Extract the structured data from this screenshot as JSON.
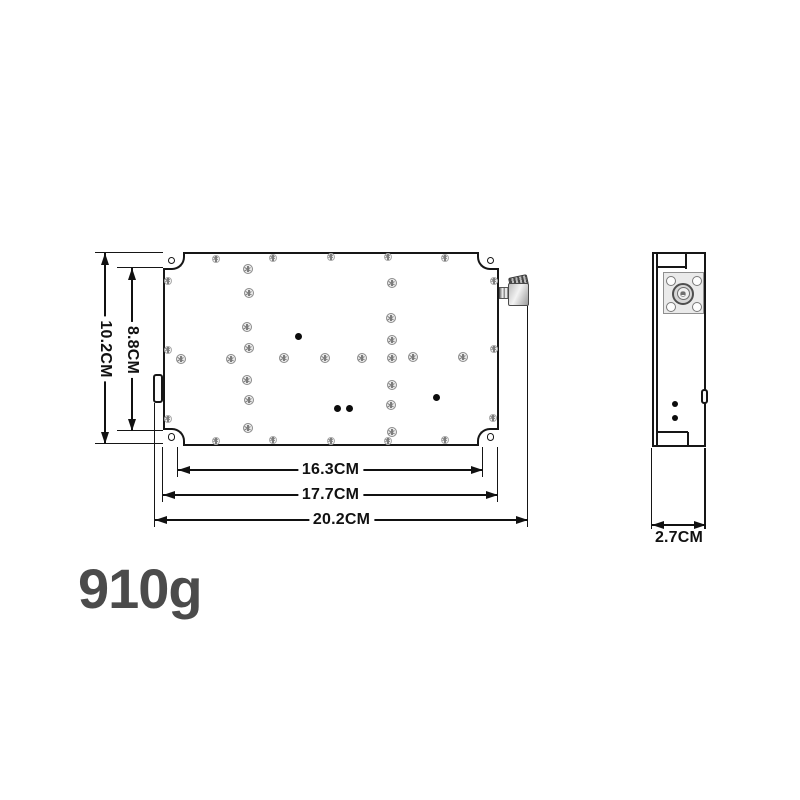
{
  "weight_label": "910g",
  "palette": {
    "line": "#161616",
    "text": "#111111",
    "weight_text": "#4b4b4b"
  },
  "front_view": {
    "body": {
      "x": 163,
      "y": 252,
      "w": 336,
      "h": 194
    },
    "corner_lugs": [
      {
        "corner": "tl",
        "x": 163,
        "y": 252,
        "w": 22,
        "h": 18,
        "hole": [
          171.5,
          260.5
        ]
      },
      {
        "corner": "tr",
        "x": 477,
        "y": 252,
        "w": 22,
        "h": 18,
        "hole": [
          490.5,
          260.5
        ]
      },
      {
        "corner": "bl",
        "x": 163,
        "y": 428,
        "w": 22,
        "h": 18,
        "hole": [
          171.5,
          437
        ]
      },
      {
        "corner": "br",
        "x": 477,
        "y": 428,
        "w": 22,
        "h": 18,
        "hole": [
          490.5,
          437
        ]
      }
    ],
    "hole_d": 7.5,
    "tab": {
      "x": 153,
      "y": 374,
      "w": 10,
      "h": 29
    },
    "connector": [
      {
        "cls": "kind-thread",
        "x": 499,
        "y": 287,
        "w": 12,
        "h": 12
      },
      {
        "cls": "kind-knurl",
        "x": 509,
        "y": 276,
        "w": 19,
        "h": 11
      },
      {
        "cls": "kind-nut",
        "x": 508,
        "y": 283,
        "w": 21,
        "h": 23
      }
    ],
    "screws_star": [
      [
        216,
        259
      ],
      [
        273,
        258
      ],
      [
        331,
        257
      ],
      [
        388,
        257
      ],
      [
        445,
        258
      ],
      [
        216,
        441
      ],
      [
        273,
        440
      ],
      [
        331,
        441
      ],
      [
        388,
        441
      ],
      [
        445,
        440
      ],
      [
        168,
        281
      ],
      [
        168,
        350
      ],
      [
        168,
        419
      ],
      [
        494,
        281
      ],
      [
        494,
        349
      ],
      [
        493,
        418
      ]
    ],
    "screws_cross": [
      [
        248,
        269
      ],
      [
        249,
        293
      ],
      [
        247,
        327
      ],
      [
        249,
        348
      ],
      [
        247,
        380
      ],
      [
        249,
        400
      ],
      [
        248,
        428
      ],
      [
        392,
        283
      ],
      [
        391,
        318
      ],
      [
        392,
        340
      ],
      [
        392,
        385
      ],
      [
        391,
        405
      ],
      [
        392,
        432
      ],
      [
        181,
        359
      ],
      [
        231,
        359
      ],
      [
        284,
        358
      ],
      [
        325,
        358
      ],
      [
        362,
        358
      ],
      [
        392,
        358
      ],
      [
        413,
        357
      ],
      [
        463,
        357
      ]
    ],
    "dot_d": 7,
    "dots": [
      [
        298,
        336
      ],
      [
        337,
        408
      ],
      [
        349,
        408
      ],
      [
        436,
        397
      ]
    ]
  },
  "side_view": {
    "body": {
      "x": 652,
      "y": 252,
      "w": 54,
      "h": 195
    },
    "inner_lines": [
      {
        "x": 657,
        "y": 252,
        "len": 195,
        "dir": "v"
      },
      {
        "x": 657,
        "y": 267,
        "len": 29,
        "dir": "h"
      },
      {
        "x": 686,
        "y": 252,
        "len": 17,
        "dir": "v"
      },
      {
        "x": 657,
        "y": 432,
        "len": 31,
        "dir": "h"
      },
      {
        "x": 688,
        "y": 432,
        "len": 15,
        "dir": "v"
      }
    ],
    "flange": {
      "x": 663,
      "y": 272,
      "w": 41,
      "h": 42
    },
    "flange_holes": [
      [
        670.5,
        280.5
      ],
      [
        696.5,
        280.5
      ],
      [
        670.5,
        306.5
      ],
      [
        696.5,
        306.5
      ]
    ],
    "flange_hole_d": 10,
    "rings": [
      {
        "cx": 683,
        "cy": 293.5,
        "d": 22,
        "cls": "ring-outer"
      },
      {
        "cx": 683,
        "cy": 293.5,
        "d": 13,
        "cls": "ring-inner"
      },
      {
        "cx": 683,
        "cy": 293.5,
        "d": 6,
        "cls": "ring-core"
      }
    ],
    "center_square": {
      "cx": 683,
      "cy": 293.5,
      "s": 3.5
    },
    "notch": {
      "x": 701,
      "y": 389,
      "w": 7,
      "h": 15
    },
    "dot_d": 6.5,
    "dots": [
      [
        675,
        404
      ],
      [
        675,
        418
      ]
    ]
  },
  "dimensions": [
    {
      "label": "10.2CM",
      "orient": "v",
      "x": 105,
      "from": 253,
      "to": 444,
      "ext": [
        {
          "x": 95,
          "y": 252.5,
          "len": 68,
          "dir": "h"
        },
        {
          "x": 95,
          "y": 443.5,
          "len": 68,
          "dir": "h"
        }
      ]
    },
    {
      "label": "8.8CM",
      "orient": "v",
      "x": 132,
      "from": 268,
      "to": 431,
      "ext": [
        {
          "x": 117,
          "y": 267.5,
          "len": 46,
          "dir": "h"
        },
        {
          "x": 117,
          "y": 430.5,
          "len": 46,
          "dir": "h"
        }
      ]
    },
    {
      "label": "16.3CM",
      "orient": "h",
      "y": 470,
      "from": 178,
      "to": 483,
      "ext": [
        {
          "x": 177.5,
          "y": 447,
          "len": 30,
          "dir": "v"
        },
        {
          "x": 482.5,
          "y": 447,
          "len": 30,
          "dir": "v"
        }
      ]
    },
    {
      "label": "17.7CM",
      "orient": "h",
      "y": 495,
      "from": 163,
      "to": 498,
      "ext": [
        {
          "x": 162.5,
          "y": 447,
          "len": 55,
          "dir": "v"
        },
        {
          "x": 497.5,
          "y": 447,
          "len": 55,
          "dir": "v"
        }
      ]
    },
    {
      "label": "20.2CM",
      "orient": "h",
      "y": 520,
      "from": 155,
      "to": 528,
      "ext": [
        {
          "x": 154.5,
          "y": 403,
          "len": 124,
          "dir": "v"
        },
        {
          "x": 527.5,
          "y": 306,
          "len": 221,
          "dir": "v"
        }
      ]
    },
    {
      "label": "2.7CM",
      "orient": "h",
      "y": 525,
      "from": 652,
      "to": 706,
      "label_below": true,
      "ext": [
        {
          "x": 651.5,
          "y": 448,
          "len": 84,
          "dir": "v"
        },
        {
          "x": 705,
          "y": 448,
          "len": 84,
          "dir": "v"
        }
      ]
    }
  ]
}
